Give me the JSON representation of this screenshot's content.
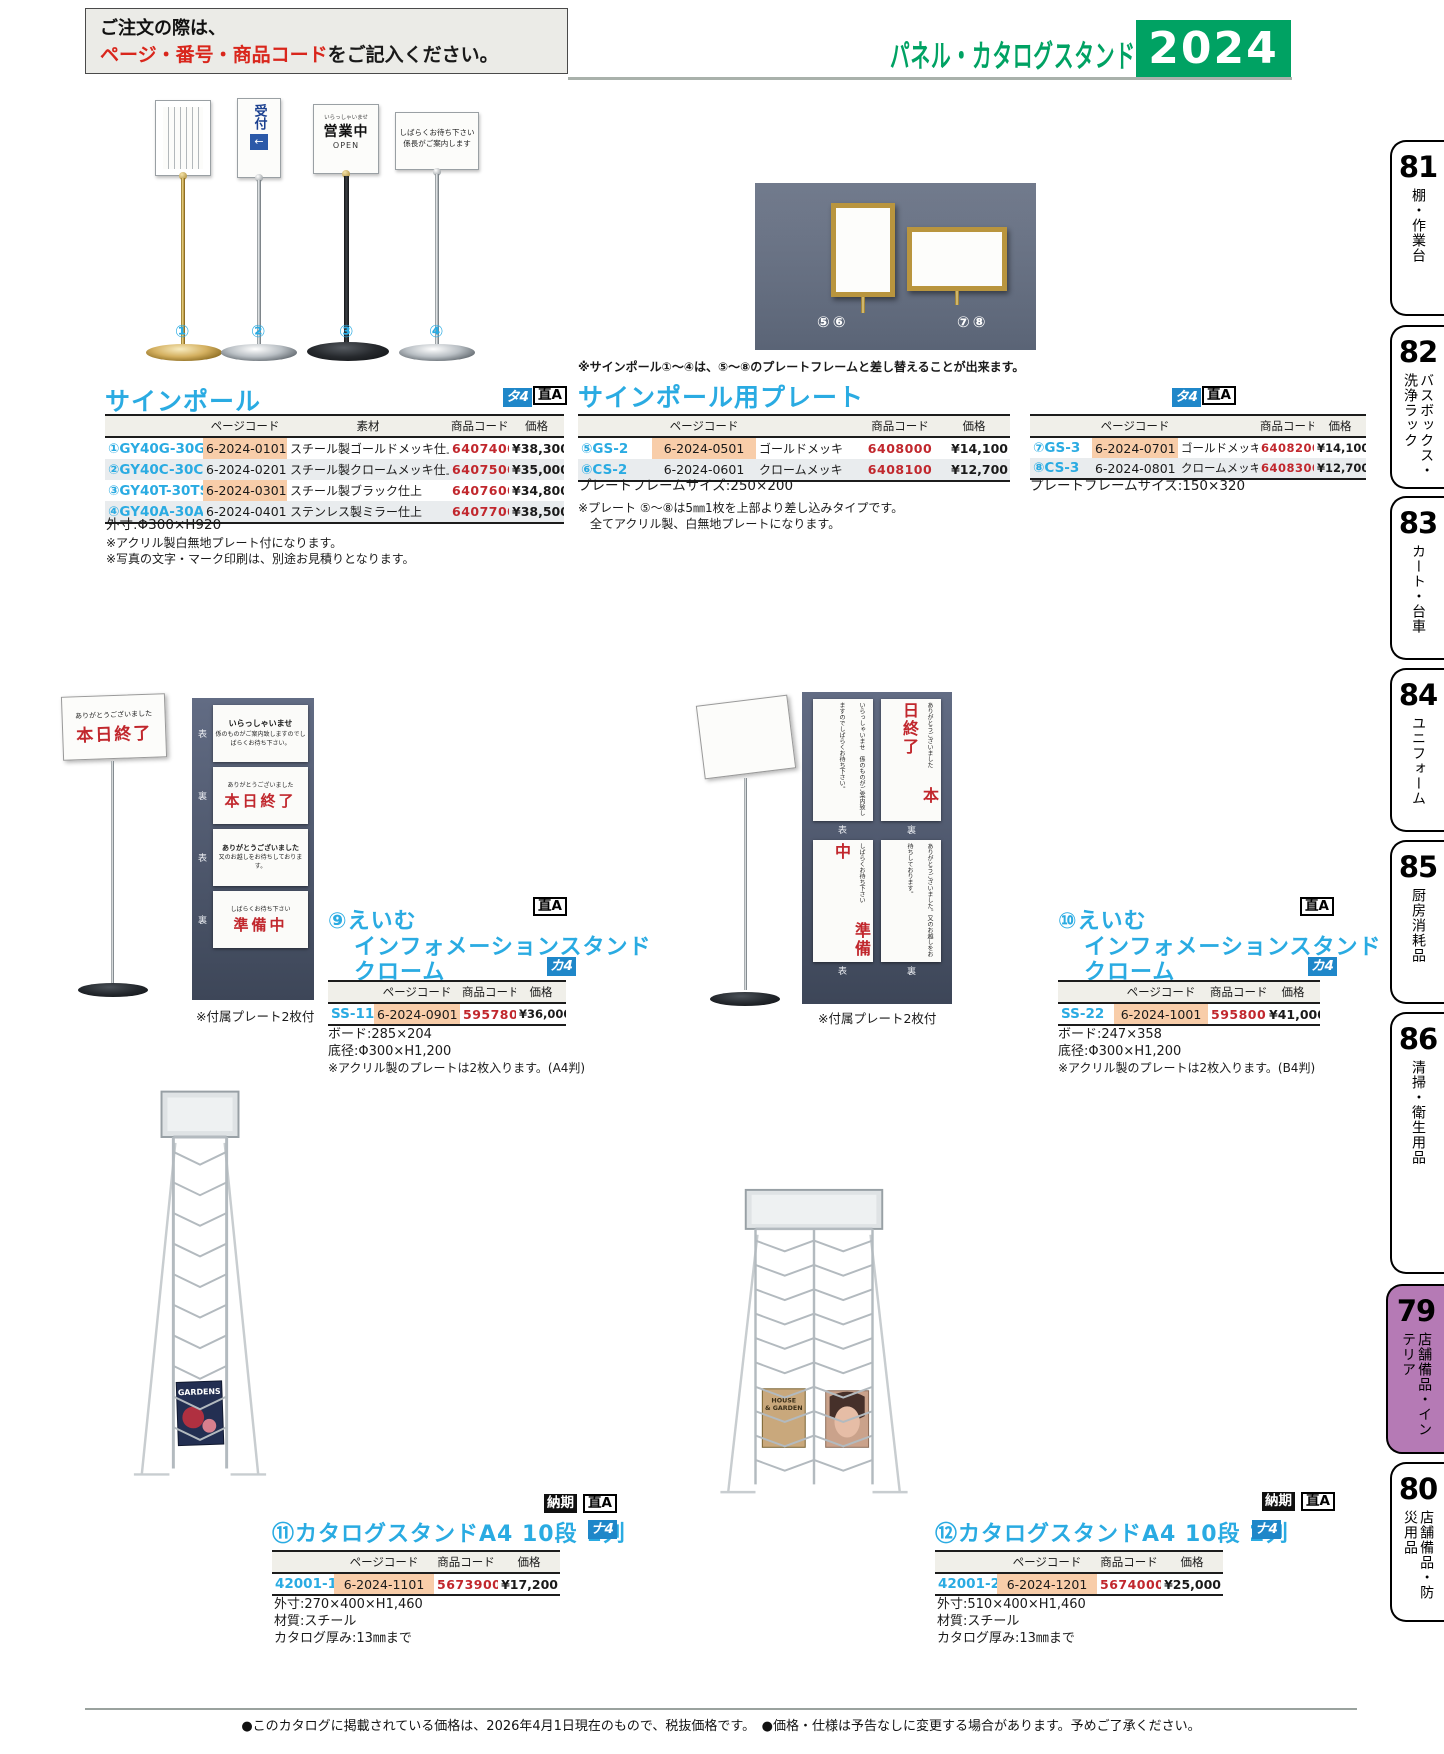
{
  "header": {
    "order_line1": "ご注文の際は、",
    "order_red": "ページ・番号・商品コード",
    "order_tail": "をご記入ください。",
    "category_title": "パネル・カタログスタンド",
    "year": "2024"
  },
  "badges": {
    "ta4": "タ4",
    "ka4": "カ4",
    "na4": "ナ4",
    "dir_a": "直A",
    "nouki": "納期"
  },
  "colors": {
    "accent_blue": "#2aabe2",
    "brand_green": "#00a263",
    "item_code_red": "#c1272d",
    "page_code_highlight": "#f8cda9",
    "active_tab_purple": "#b57ab5",
    "badge_blue": "#1f87c9"
  },
  "sidebar": {
    "tabs": [
      {
        "num": "81",
        "label": "棚・作業台"
      },
      {
        "num": "82",
        "label": "バスボックス・洗浄ラック"
      },
      {
        "num": "83",
        "label": "カート・台車"
      },
      {
        "num": "84",
        "label": "ユニフォーム"
      },
      {
        "num": "85",
        "label": "厨房消耗品"
      },
      {
        "num": "86",
        "label": "清掃・衛生用品"
      },
      {
        "num": "79",
        "label": "店舗備品・インテリア"
      },
      {
        "num": "80",
        "label": "店舗備品・防災用品"
      }
    ]
  },
  "s1": {
    "title": "サインポール",
    "item_nums": [
      "①",
      "②",
      "③",
      "④"
    ],
    "plates": {
      "p2_text": "受付",
      "p2_arrow": "←",
      "p3_line1": "いらっしゃいませ",
      "p3_line2": "営業中",
      "p3_line3": "OPEN",
      "p4_line1": "しばらくお待ち下さい",
      "p4_line2": "係長がご案内します"
    },
    "headers": [
      "",
      "ページコード",
      "素材",
      "商品コード",
      "価格"
    ],
    "rows": [
      {
        "model": "①GY40G-30GS",
        "page_code": "6-2024-0101",
        "material": "スチール製ゴールドメッキ仕上",
        "item_code": "6407400",
        "price": "¥38,300"
      },
      {
        "model": "②GY40C-30CS",
        "page_code": "6-2024-0201",
        "material": "スチール製クロームメッキ仕上",
        "item_code": "6407500",
        "price": "¥35,000"
      },
      {
        "model": "③GY40T-30TS",
        "page_code": "6-2024-0301",
        "material": "スチール製ブラック仕上",
        "item_code": "6407600",
        "price": "¥34,800"
      },
      {
        "model": "④GY40A-30AS",
        "page_code": "6-2024-0401",
        "material": "ステンレス製ミラー仕上",
        "item_code": "6407700",
        "price": "¥38,500"
      }
    ],
    "notes": [
      "外寸:Φ300×H920",
      "※アクリル製白無地プレート付になります。",
      "※写真の文字・マーク印刷は、別途お見積りとなります。"
    ]
  },
  "s2": {
    "title": "サインポール用プレート",
    "note_top": "※サインポール①〜④は、⑤〜⑧のプレートフレームと差し替えることが出来ます。",
    "photo_nums_left": "⑤⑥",
    "photo_nums_right": "⑦⑧",
    "headers": [
      "",
      "ページコード",
      "",
      "商品コード",
      "価格"
    ],
    "rows_left": [
      {
        "model": "⑤GS-2",
        "page_code": "6-2024-0501",
        "material": "ゴールドメッキ",
        "item_code": "6408000",
        "price": "¥14,100"
      },
      {
        "model": "⑥CS-2",
        "page_code": "6-2024-0601",
        "material": "クロームメッキ",
        "item_code": "6408100",
        "price": "¥12,700"
      }
    ],
    "note_left": "プレートフレームサイズ:250×200",
    "rows_right": [
      {
        "model": "⑦GS-3",
        "page_code": "6-2024-0701",
        "material": "ゴールドメッキ",
        "item_code": "6408200",
        "price": "¥14,100"
      },
      {
        "model": "⑧CS-3",
        "page_code": "6-2024-0801",
        "material": "クロームメッキ",
        "item_code": "6408300",
        "price": "¥12,700"
      }
    ],
    "note_right": "プレートフレームサイズ:150×320",
    "notes": [
      "※プレート ⑤〜⑧は5㎜1枚を上部より差し込みタイプです。",
      "全てアクリル製、白無地プレートになります。"
    ]
  },
  "s9": {
    "title_line1": "⑨えいむ",
    "title_line2": "インフォメーションスタンド",
    "title_line3": "クローム",
    "caption": "※付属プレート2枚付",
    "stand_plate": {
      "small": "ありがとうございました",
      "big": "本日終了"
    },
    "board": {
      "rows": [
        {
          "label": "表",
          "title": "いらっしゃいませ",
          "lines": "係のものがご案内致しますのでしばらくお待ち下さい。",
          "big": ""
        },
        {
          "label": "裏",
          "title": "ありがとうございました",
          "lines": "",
          "big": "本日終了"
        },
        {
          "label": "表",
          "title": "ありがとうございました",
          "lines": "又のお越しをお待ちしております。",
          "big": ""
        },
        {
          "label": "裏",
          "title": "しばらくお待ち下さい",
          "lines": "",
          "big": "準備中"
        }
      ]
    },
    "headers": [
      "",
      "ページコード",
      "商品コード",
      "価格"
    ],
    "row": {
      "model": "SS-11",
      "page_code": "6-2024-0901",
      "item_code": "5957800",
      "price": "¥36,000"
    },
    "notes": [
      "ボード:285×204",
      "底径:Φ300×H1,200",
      "※アクリル製のプレートは2枚入ります。(A4判)"
    ]
  },
  "s10": {
    "title_line1": "⑩えいむ",
    "title_line2": "インフォメーションスタンド",
    "title_line3": "クローム",
    "caption": "※付属プレート2枚付",
    "board": {
      "cells": [
        {
          "small": "いらっしゃいませ　係のものがご案内致しますのでしばらくお待ち下さい。",
          "big": ""
        },
        {
          "small": "ありがとうございました",
          "big": "本日終了"
        },
        {
          "small": "しばらくお待ち下さい",
          "big": "準備中"
        },
        {
          "small": "ありがとうございました。又のお越しをお待ちしております。",
          "big": ""
        }
      ],
      "labels_row1": [
        "表",
        "裏"
      ],
      "labels_row2": [
        "表",
        "裏"
      ]
    },
    "headers": [
      "",
      "ページコード",
      "商品コード",
      "価格"
    ],
    "row": {
      "model": "SS-22",
      "page_code": "6-2024-1001",
      "item_code": "5958000",
      "price": "¥41,000"
    },
    "notes": [
      "ボード:247×358",
      "底径:Φ300×H1,200",
      "※アクリル製のプレートは2枚入ります。(B4判)"
    ]
  },
  "s11": {
    "title": "⑪カタログスタンドA4 10段 1列",
    "magazine": "GARDENS",
    "headers": [
      "",
      "ページコード",
      "商品コード",
      "価格"
    ],
    "row": {
      "model": "42001-1",
      "page_code": "6-2024-1101",
      "item_code": "5673900",
      "price": "¥17,200"
    },
    "notes": [
      "外寸:270×400×H1,460",
      "材質:スチール",
      "カタログ厚み:13㎜まで"
    ]
  },
  "s12": {
    "title": "⑫カタログスタンドA4 10段 2列",
    "mag_line1": "HOUSE",
    "mag_line2": "& GARDEN",
    "headers": [
      "",
      "ページコード",
      "商品コード",
      "価格"
    ],
    "row": {
      "model": "42001-2",
      "page_code": "6-2024-1201",
      "item_code": "5674000",
      "price": "¥25,000"
    },
    "notes": [
      "外寸:510×400×H1,460",
      "材質:スチール",
      "カタログ厚み:13㎜まで"
    ]
  },
  "footer": {
    "text": "●このカタログに掲載されている価格は、2026年4月1日現在のもので、税抜価格です。　●価格・仕様は予告なしに変更する場合があります。予めご了承ください。"
  }
}
